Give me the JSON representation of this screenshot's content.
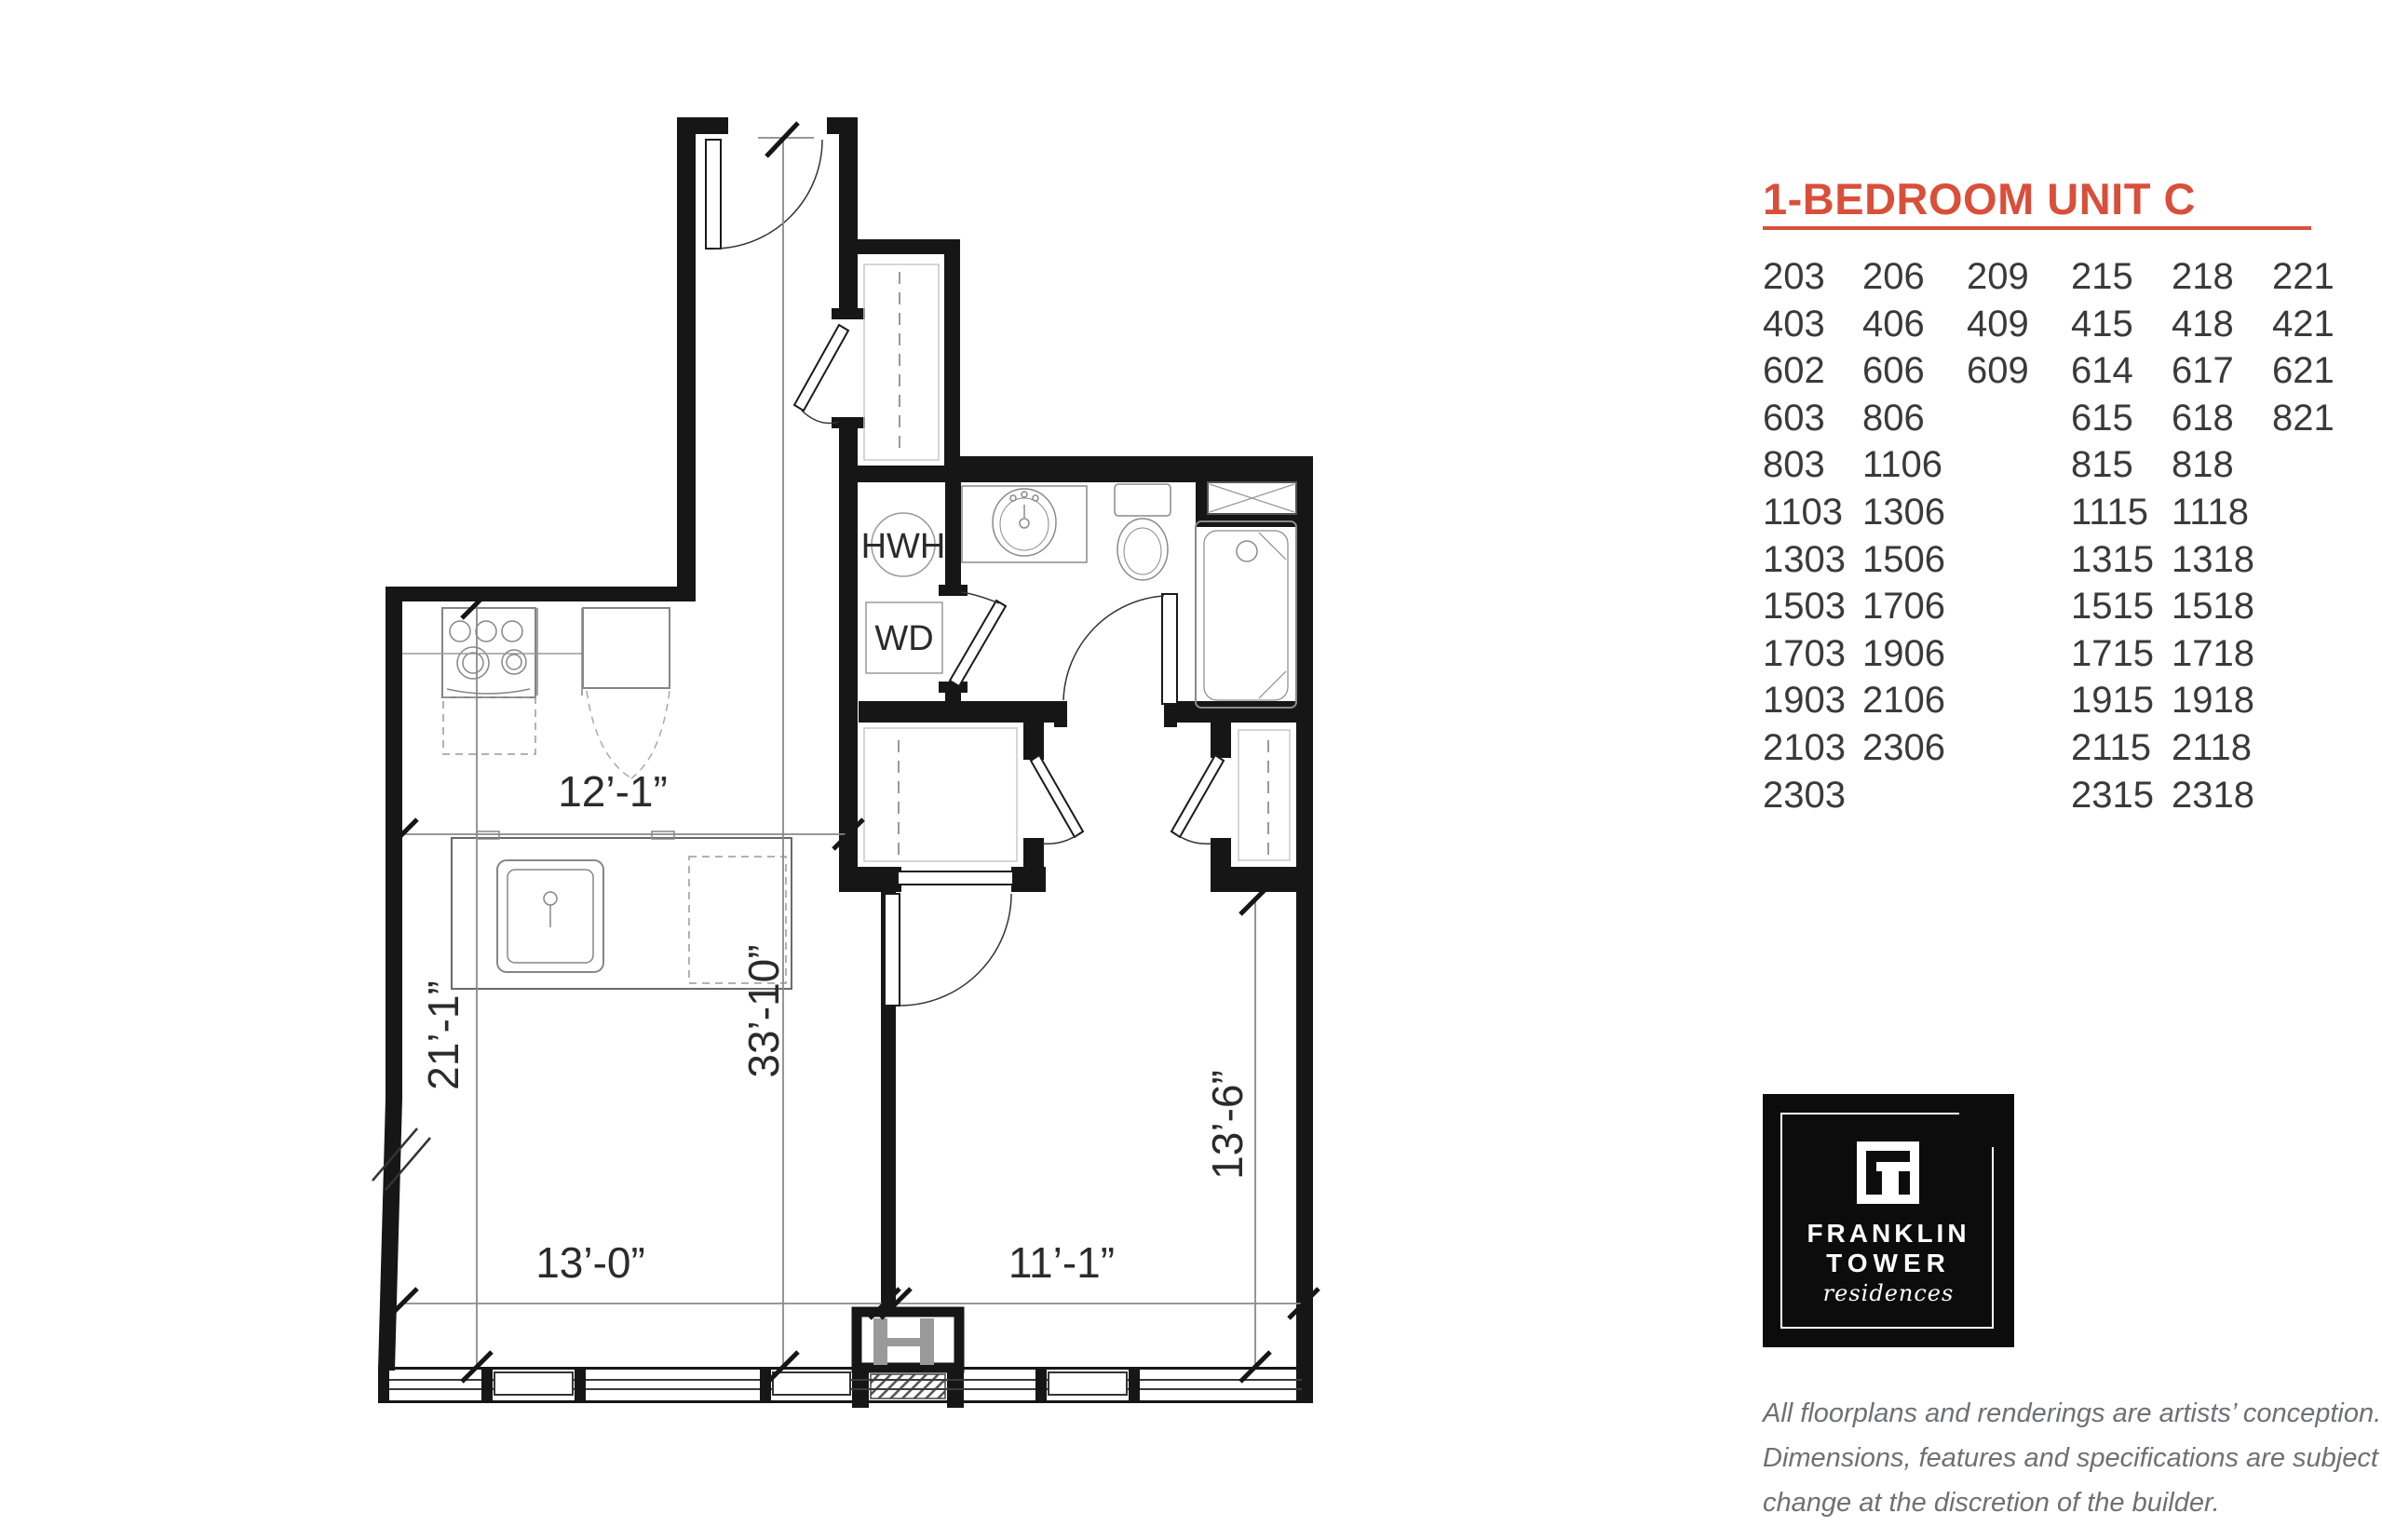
{
  "accent_color": "#d94f3a",
  "header": {
    "title": "1-BEDROOM UNIT C"
  },
  "units": {
    "rows": [
      [
        "203",
        "206",
        "209",
        "215",
        "218",
        "221"
      ],
      [
        "403",
        "406",
        "409",
        "415",
        "418",
        "421"
      ],
      [
        "602",
        "606",
        "609",
        "614",
        "617",
        "621"
      ],
      [
        "603",
        "806",
        "",
        "615",
        "618",
        "821"
      ],
      [
        "803",
        "1106",
        "",
        "815",
        "818",
        ""
      ],
      [
        "1103",
        "1306",
        "",
        "1115",
        "1118",
        ""
      ],
      [
        "1303",
        "1506",
        "",
        "1315",
        "1318",
        ""
      ],
      [
        "1503",
        "1706",
        "",
        "1515",
        "1518",
        ""
      ],
      [
        "1703",
        "1906",
        "",
        "1715",
        "1718",
        ""
      ],
      [
        "1903",
        "2106",
        "",
        "1915",
        "1918",
        ""
      ],
      [
        "2103",
        "2306",
        "",
        "2115",
        "2118",
        ""
      ],
      [
        "2303",
        "",
        "",
        "2315",
        "2318",
        ""
      ]
    ]
  },
  "plan": {
    "labels": {
      "hwh": "HWH",
      "wd": "WD"
    },
    "dimensions": {
      "kitchen_width": "12’-1”",
      "living_depth": "21’-1”",
      "overall_depth": "33’-10”",
      "living_width": "13’-0”",
      "bedroom_width": "11’-1”",
      "bedroom_depth": "13’-6”"
    }
  },
  "logo": {
    "line1": "FRANKLIN",
    "line2": "TOWER",
    "line3": "residences"
  },
  "disclaimer": {
    "line1": "All floorplans and renderings are artists’ conception.",
    "line2": "Dimensions, features and specifications are subject to",
    "line3": "change at the discretion of the builder."
  }
}
